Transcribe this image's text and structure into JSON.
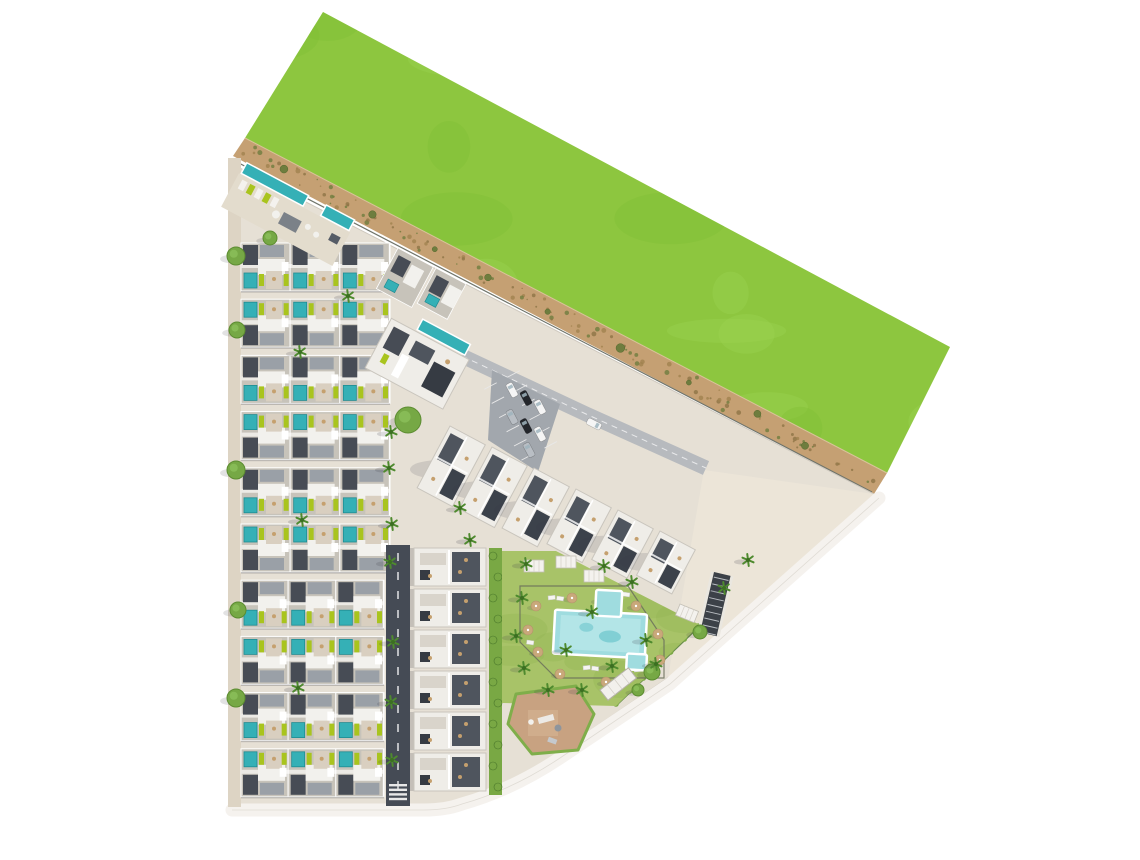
{
  "meta": {
    "type": "architectural-site-plan",
    "view": "aerial-top-down",
    "subject": "residential-complex-masterplan"
  },
  "palette": {
    "bg": "#ffffff",
    "grass": "#8dc63f",
    "grassLight": "#9dd352",
    "grassDark": "#7fbc33",
    "sand": "#c5a073",
    "sandDark": "#a0824f",
    "sandDot": "#8d7446",
    "bush": "#6e7d3e",
    "bushDark": "#55682e",
    "ground": "#e6e0d5",
    "plaza": "#ece5d8",
    "sidewalk": "#ddd4c4",
    "roadDark": "#454b55",
    "roadLine": "#d8dadc",
    "whiteRoad": "#f5f2ee",
    "whiteRoadEdge": "#dfdbd4",
    "asphalt": "#a2a7ad",
    "roofBase": "#c7c3ba",
    "roofWhite": "#f2f1ed",
    "roofGray": "#9aa0a7",
    "roofDark": "#474c55",
    "roofDarker": "#363b43",
    "terrace": "#d9cfc0",
    "parapet": "#ffffff",
    "poolPrivate": "#35b0b6",
    "poolPrivateDark": "#1f8c92",
    "lime": "#a9c41e",
    "blockWhite": "#efede8",
    "blockStroke": "#c9c5bd",
    "deckDark": "#4f555e",
    "deckDarker": "#3c424b",
    "lawn": "#a8c368",
    "lawnDark": "#93b454",
    "bigPool": "#9fdcdf",
    "bigPoolLight": "#bce8ea",
    "bigPoolDeep": "#5fbfc8",
    "fence": "#6b705c",
    "umbrella": "#c9a87a",
    "furniture": "#c5a06e",
    "treeRound": "#76a845",
    "treeRoundDark": "#5c8c31",
    "palm": "#4e8a2e",
    "palmDark": "#3c6f22",
    "hedge": "#79a844",
    "hedgeDark": "#49762a",
    "playground": "#c8a281",
    "playBorder": "#7fae4a",
    "playInner": "#d6b494",
    "rampDark": "#3c4148",
    "rampStripe": "#b9bdc2",
    "carWhite": "#f5f5f5",
    "carBlack": "#23262b",
    "carSilver": "#b9bec4",
    "shadow": "#3c3c46"
  },
  "scene": {
    "canvas": {
      "width": 1140,
      "height": 860
    },
    "grass": {
      "polygon": [
        [
          323,
          12
        ],
        [
          950,
          347
        ],
        [
          887,
          473
        ],
        [
          245,
          138
        ]
      ],
      "blob_count": 30
    },
    "sand_strip": {
      "polygon": [
        [
          245,
          138
        ],
        [
          887,
          473
        ],
        [
          874,
          494
        ],
        [
          233,
          156
        ]
      ],
      "axis_a": [
        239,
        147
      ],
      "axis_b": [
        880,
        483
      ],
      "speckle_count": 120,
      "bush_count": 9
    },
    "ground_path": "M232,164 L874,494 L666,679 L557,753 Q510,786 460,800 Q445,806 425,806 L232,806 Z",
    "plaza_polygon": [
      [
        704,
        470
      ],
      [
        874,
        494
      ],
      [
        668,
        678
      ]
    ],
    "boundary_road_path": "M879,498 L670,684 L560,758 Q512,790 462,804 Q446,810 424,810 L232,810",
    "left_sidewalk": [
      228,
      158,
      13,
      649
    ],
    "townhouse_rows": {
      "count": 10,
      "y0": 243,
      "pitch": 56.2,
      "height": 48,
      "x0": 241,
      "x1_upper": 390,
      "x1_lower": 384,
      "units_per_row": 3
    },
    "annex_blocks": [
      [
        398,
        248,
        40,
        46
      ],
      [
        436,
        268,
        34,
        40
      ]
    ],
    "vertical_road": [
      386,
      545,
      24,
      261
    ],
    "access_road": {
      "points": [
        [
          462,
          356
        ],
        [
          586,
          414
        ],
        [
          706,
          468
        ]
      ],
      "width": 15
    },
    "parking": {
      "polygon": [
        [
          492,
          370
        ],
        [
          560,
          404
        ],
        [
          538,
          472
        ],
        [
          488,
          440
        ]
      ],
      "lane": [
        [
          502,
          380
        ],
        [
          545,
          462
        ]
      ],
      "stall_count": 6,
      "cars": [
        [
          512,
          390,
          -28,
          "carWhite"
        ],
        [
          526,
          398,
          -28,
          "carBlack"
        ],
        [
          540,
          407,
          -28,
          "carWhite"
        ],
        [
          512,
          417,
          -28,
          "carSilver"
        ],
        [
          526,
          426,
          -28,
          "carBlack"
        ],
        [
          540,
          434,
          -28,
          "carWhite"
        ],
        [
          529,
          450,
          -28,
          "carSilver"
        ],
        [
          594,
          424,
          117,
          "carWhite"
        ]
      ]
    },
    "nw_amenity": {
      "origin": [
        246,
        160
      ],
      "angle": 28,
      "deck": [
        0,
        15,
        126,
        38
      ],
      "pools": [
        [
          2,
          2,
          70,
          12
        ],
        [
          92,
          2,
          32,
          12
        ]
      ],
      "sunbed_count": 5
    },
    "clubhouse": {
      "origin": [
        398,
        306
      ],
      "angle": 28,
      "base": [
        0,
        14,
        88,
        56
      ],
      "pool": [
        28,
        0,
        54,
        12
      ]
    },
    "apartment_chain": {
      "angle": 28,
      "width": 40,
      "stripes": [
        [
          450,
          426,
          70
        ],
        [
          492,
          447,
          70
        ],
        [
          534,
          468,
          68
        ],
        [
          576,
          489,
          62
        ],
        [
          618,
          510,
          56
        ],
        [
          660,
          531,
          50
        ]
      ]
    },
    "lower_apartments": {
      "x": 414,
      "w": 72,
      "h": 38,
      "ys": [
        548,
        589,
        630,
        671,
        712,
        753
      ]
    },
    "hedge_strip": [
      489,
      548,
      13,
      247
    ],
    "garden": {
      "polygon": [
        [
          502,
          551
        ],
        [
          556,
          551
        ],
        [
          700,
          625
        ],
        [
          616,
          706
        ],
        [
          502,
          703
        ]
      ],
      "fence": [
        [
          520,
          586
        ],
        [
          628,
          586
        ],
        [
          664,
          640
        ],
        [
          664,
          678
        ],
        [
          556,
          678
        ],
        [
          520,
          642
        ]
      ],
      "pergolas": [
        [
          524,
          560,
          0
        ],
        [
          556,
          556,
          0
        ],
        [
          584,
          570,
          0
        ],
        [
          680,
          604,
          22
        ]
      ]
    },
    "communal_pool": {
      "rotation": [
        3,
        600,
        634
      ],
      "main": [
        554,
        612,
        92,
        44
      ],
      "top_ext": [
        594,
        590,
        26,
        26
      ],
      "br_ext": [
        628,
        652,
        20,
        16
      ]
    },
    "umbrellas": [
      [
        536,
        606
      ],
      [
        528,
        630
      ],
      [
        538,
        652
      ],
      [
        560,
        674
      ],
      [
        600,
        600
      ],
      [
        636,
        606
      ],
      [
        658,
        634
      ],
      [
        660,
        660
      ],
      [
        606,
        682
      ],
      [
        572,
        598
      ]
    ],
    "loungers": [
      [
        548,
        596
      ],
      [
        557,
        596
      ],
      [
        614,
        592
      ],
      [
        623,
        592
      ],
      [
        583,
        666
      ],
      [
        592,
        666
      ],
      [
        634,
        668
      ],
      [
        527,
        640
      ]
    ],
    "playground": {
      "polygon": [
        [
          516,
          694
        ],
        [
          576,
          686
        ],
        [
          594,
          714
        ],
        [
          578,
          750
        ],
        [
          532,
          754
        ],
        [
          508,
          724
        ]
      ],
      "inner": [
        528,
        710,
        30,
        26
      ]
    },
    "ramps": {
      "white": {
        "origin": [
          600,
          690
        ],
        "angle": -38,
        "size": [
          36,
          13
        ]
      },
      "dark": {
        "origin": [
          714,
          572
        ],
        "angle": 13,
        "size": [
          17,
          62
        ]
      }
    },
    "round_trees": [
      [
        408,
        420,
        13
      ],
      [
        236,
        256,
        9
      ],
      [
        237,
        330,
        8
      ],
      [
        236,
        470,
        9
      ],
      [
        238,
        610,
        8
      ],
      [
        236,
        698,
        9
      ],
      [
        270,
        238,
        7
      ],
      [
        652,
        672,
        8
      ],
      [
        638,
        690,
        6
      ],
      [
        700,
        632,
        7
      ]
    ],
    "palms": [
      [
        391,
        432
      ],
      [
        389,
        468
      ],
      [
        392,
        524
      ],
      [
        390,
        562
      ],
      [
        393,
        642
      ],
      [
        391,
        702
      ],
      [
        392,
        760
      ],
      [
        348,
        296
      ],
      [
        300,
        352
      ],
      [
        302,
        520
      ],
      [
        298,
        688
      ],
      [
        522,
        598
      ],
      [
        516,
        636
      ],
      [
        524,
        668
      ],
      [
        548,
        690
      ],
      [
        582,
        690
      ],
      [
        612,
        666
      ],
      [
        646,
        640
      ],
      [
        592,
        612
      ],
      [
        566,
        650
      ],
      [
        604,
        566
      ],
      [
        632,
        582
      ],
      [
        526,
        564
      ],
      [
        656,
        664
      ],
      [
        724,
        588
      ],
      [
        748,
        560
      ],
      [
        460,
        508
      ],
      [
        470,
        540
      ]
    ],
    "edge_hedge": {
      "from": [
        616,
        704
      ],
      "to": [
        698,
        626
      ],
      "dot_count": 6
    }
  }
}
